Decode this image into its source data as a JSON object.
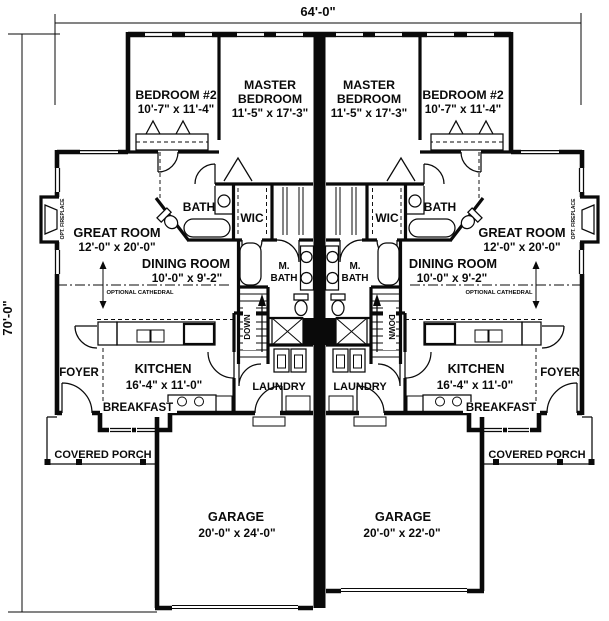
{
  "dimensions": {
    "overall_width": "64'-0\"",
    "overall_depth": "70'-0\""
  },
  "rooms": {
    "bedroom2": {
      "name": "BEDROOM #2",
      "size": "10'-7\" x 11'-4\""
    },
    "master_bedroom": {
      "line1": "MASTER",
      "line2": "BEDROOM",
      "size": "11'-5\" x 17'-3\""
    },
    "great_room": {
      "name": "GREAT ROOM",
      "size": "12'-0\" x 20'-0\""
    },
    "dining_room": {
      "name": "DINING ROOM",
      "size": "10'-0\" x 9'-2\""
    },
    "kitchen": {
      "name": "KITCHEN",
      "size": "16'-4\" x 11'-0\""
    },
    "bath": {
      "name": "BATH"
    },
    "master_bath": {
      "line1": "M.",
      "line2": "BATH"
    },
    "wic": {
      "name": "WIC"
    },
    "foyer": {
      "name": "FOYER"
    },
    "breakfast": {
      "name": "BREAKFAST"
    },
    "laundry": {
      "name": "LAUNDRY"
    },
    "covered_porch": {
      "name": "COVERED PORCH"
    },
    "garage_left": {
      "name": "GARAGE",
      "size": "20'-0\" x 24'-0\""
    },
    "garage_right": {
      "name": "GARAGE",
      "size": "20'-0\" x 22'-0\""
    }
  },
  "annotations": {
    "optional_cathedral": "OPTIONAL CATHEDRAL",
    "opt_fireplace": "OPT. FIREPLACE",
    "stairs_direction": "DOWN"
  },
  "colors": {
    "ink": "#0a0a0a",
    "paper": "#ffffff"
  }
}
